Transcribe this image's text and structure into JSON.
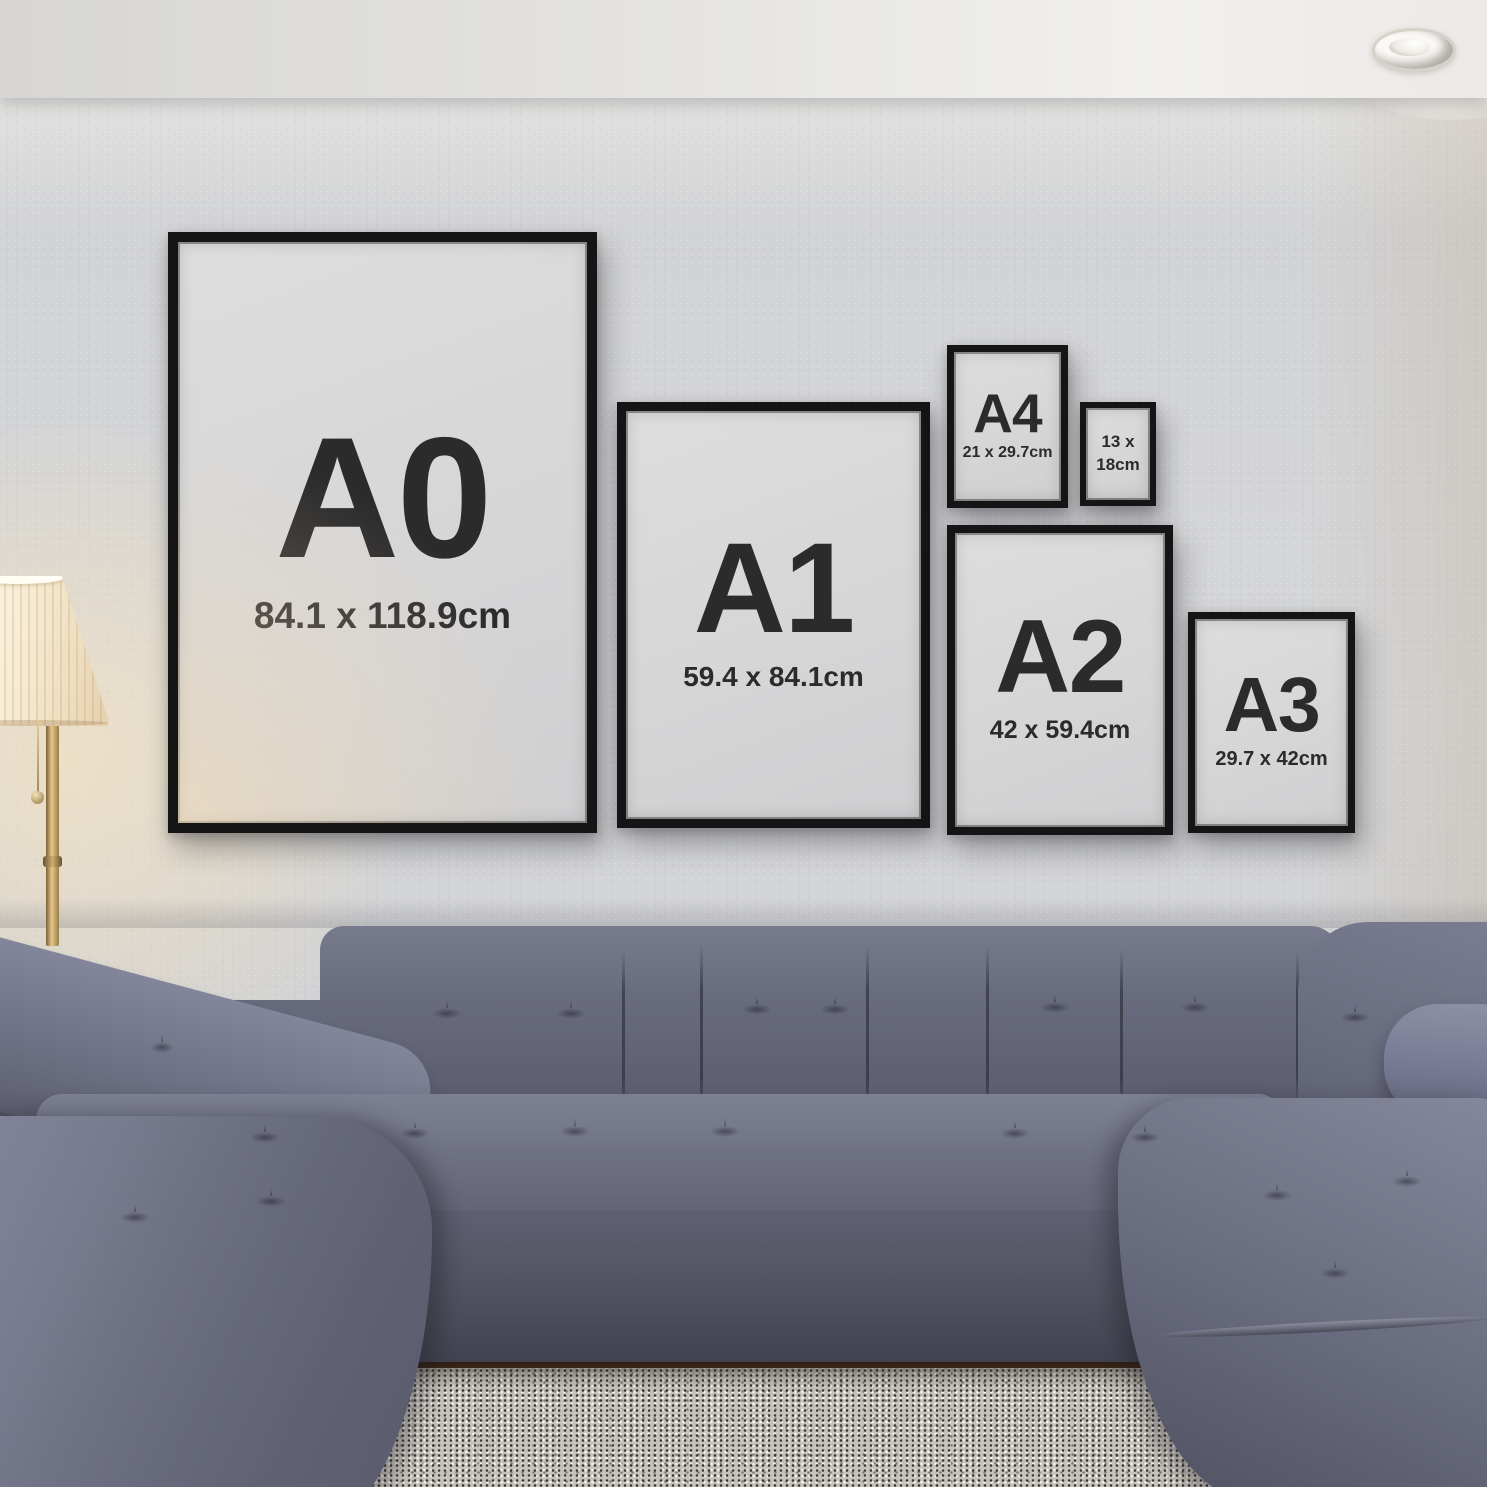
{
  "frames": [
    {
      "label": "A0",
      "dims": "84.1 x 118.9cm"
    },
    {
      "label": "A1",
      "dims": "59.4 x 84.1cm"
    },
    {
      "label": "A4",
      "dims": "21 x 29.7cm"
    },
    {
      "line1": "13 x",
      "line2": "18cm"
    },
    {
      "label": "A2",
      "dims": "42 x 59.4cm"
    },
    {
      "label": "A3",
      "dims": "29.7 x 42cm"
    }
  ],
  "colors": {
    "wall": "#d3d4d6",
    "ceiling": "#e9e8e6",
    "frame": "#151515",
    "mat": "#d8d8d8",
    "label": "#2b2b2c",
    "sofa": "#6b6e80",
    "sofa-dark": "#4e505f",
    "sofa-light": "#83869a",
    "rug": "#c7c3bc",
    "floor": "#2e2014",
    "lamp-shade": "#f7ecd9",
    "lamp-glow": "#ffe9be",
    "brass": "#b9995e"
  }
}
